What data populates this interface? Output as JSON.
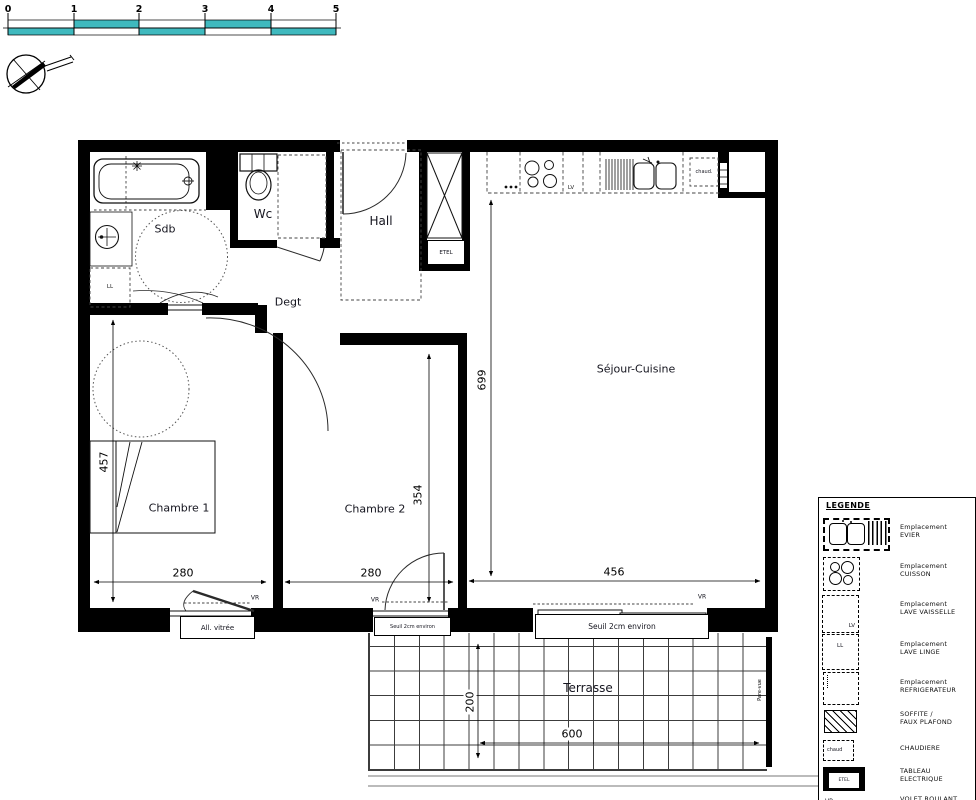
{
  "scale_bar": {
    "ticks": [
      "0",
      "1",
      "2",
      "3",
      "4",
      "5"
    ],
    "teal_color": "#3fb9be"
  },
  "plan": {
    "labels": {
      "sdb": "Sdb",
      "wc": "Wc",
      "hall": "Hall",
      "degt": "Degt",
      "sejour": "Séjour-Cuisine",
      "chambre1": "Chambre 1",
      "chambre2": "Chambre 2",
      "terrasse": "Terrasse",
      "pare_vue": "Pare-vue",
      "all_vitree": "All. vitrée",
      "seuil_c2": "Seuil 2cm environ",
      "seuil_bay": "Seuil 2cm environ",
      "vr": "VR",
      "ll": "LL",
      "lv": "LV",
      "etel": "ETEL",
      "chaud": "chaud."
    },
    "dimensions": {
      "c1_height": "457",
      "c1_width": "280",
      "c2_width": "280",
      "c2_height": "354",
      "sejour_width": "456",
      "sejour_height": "699",
      "terrasse_height": "200",
      "terrasse_width": "600"
    }
  },
  "legend": {
    "title": "LEGENDE",
    "icon_texts": {
      "lv": "LV",
      "ll": "LL",
      "chaud": "chaud",
      "etel": "ETEL",
      "vr": "VR"
    },
    "items": [
      {
        "line1": "Emplacement",
        "line2": "EVIER"
      },
      {
        "line1": "Emplacement",
        "line2": "CUISSON"
      },
      {
        "line1": "Emplacement",
        "line2": "LAVE VAISSELLE"
      },
      {
        "line1": "Emplacement",
        "line2": "LAVE LINGE"
      },
      {
        "line1": "Emplacement",
        "line2": "REFRIGERATEUR"
      },
      {
        "line1": "SOFFITE /",
        "line2": "FAUX PLAFOND"
      },
      {
        "line1": "CHAUDIERE",
        "line2": ""
      },
      {
        "line1": "TABLEAU",
        "line2": "ELECTRIQUE"
      },
      {
        "line1": "VOLET ROULANT",
        "line2": ""
      }
    ]
  }
}
